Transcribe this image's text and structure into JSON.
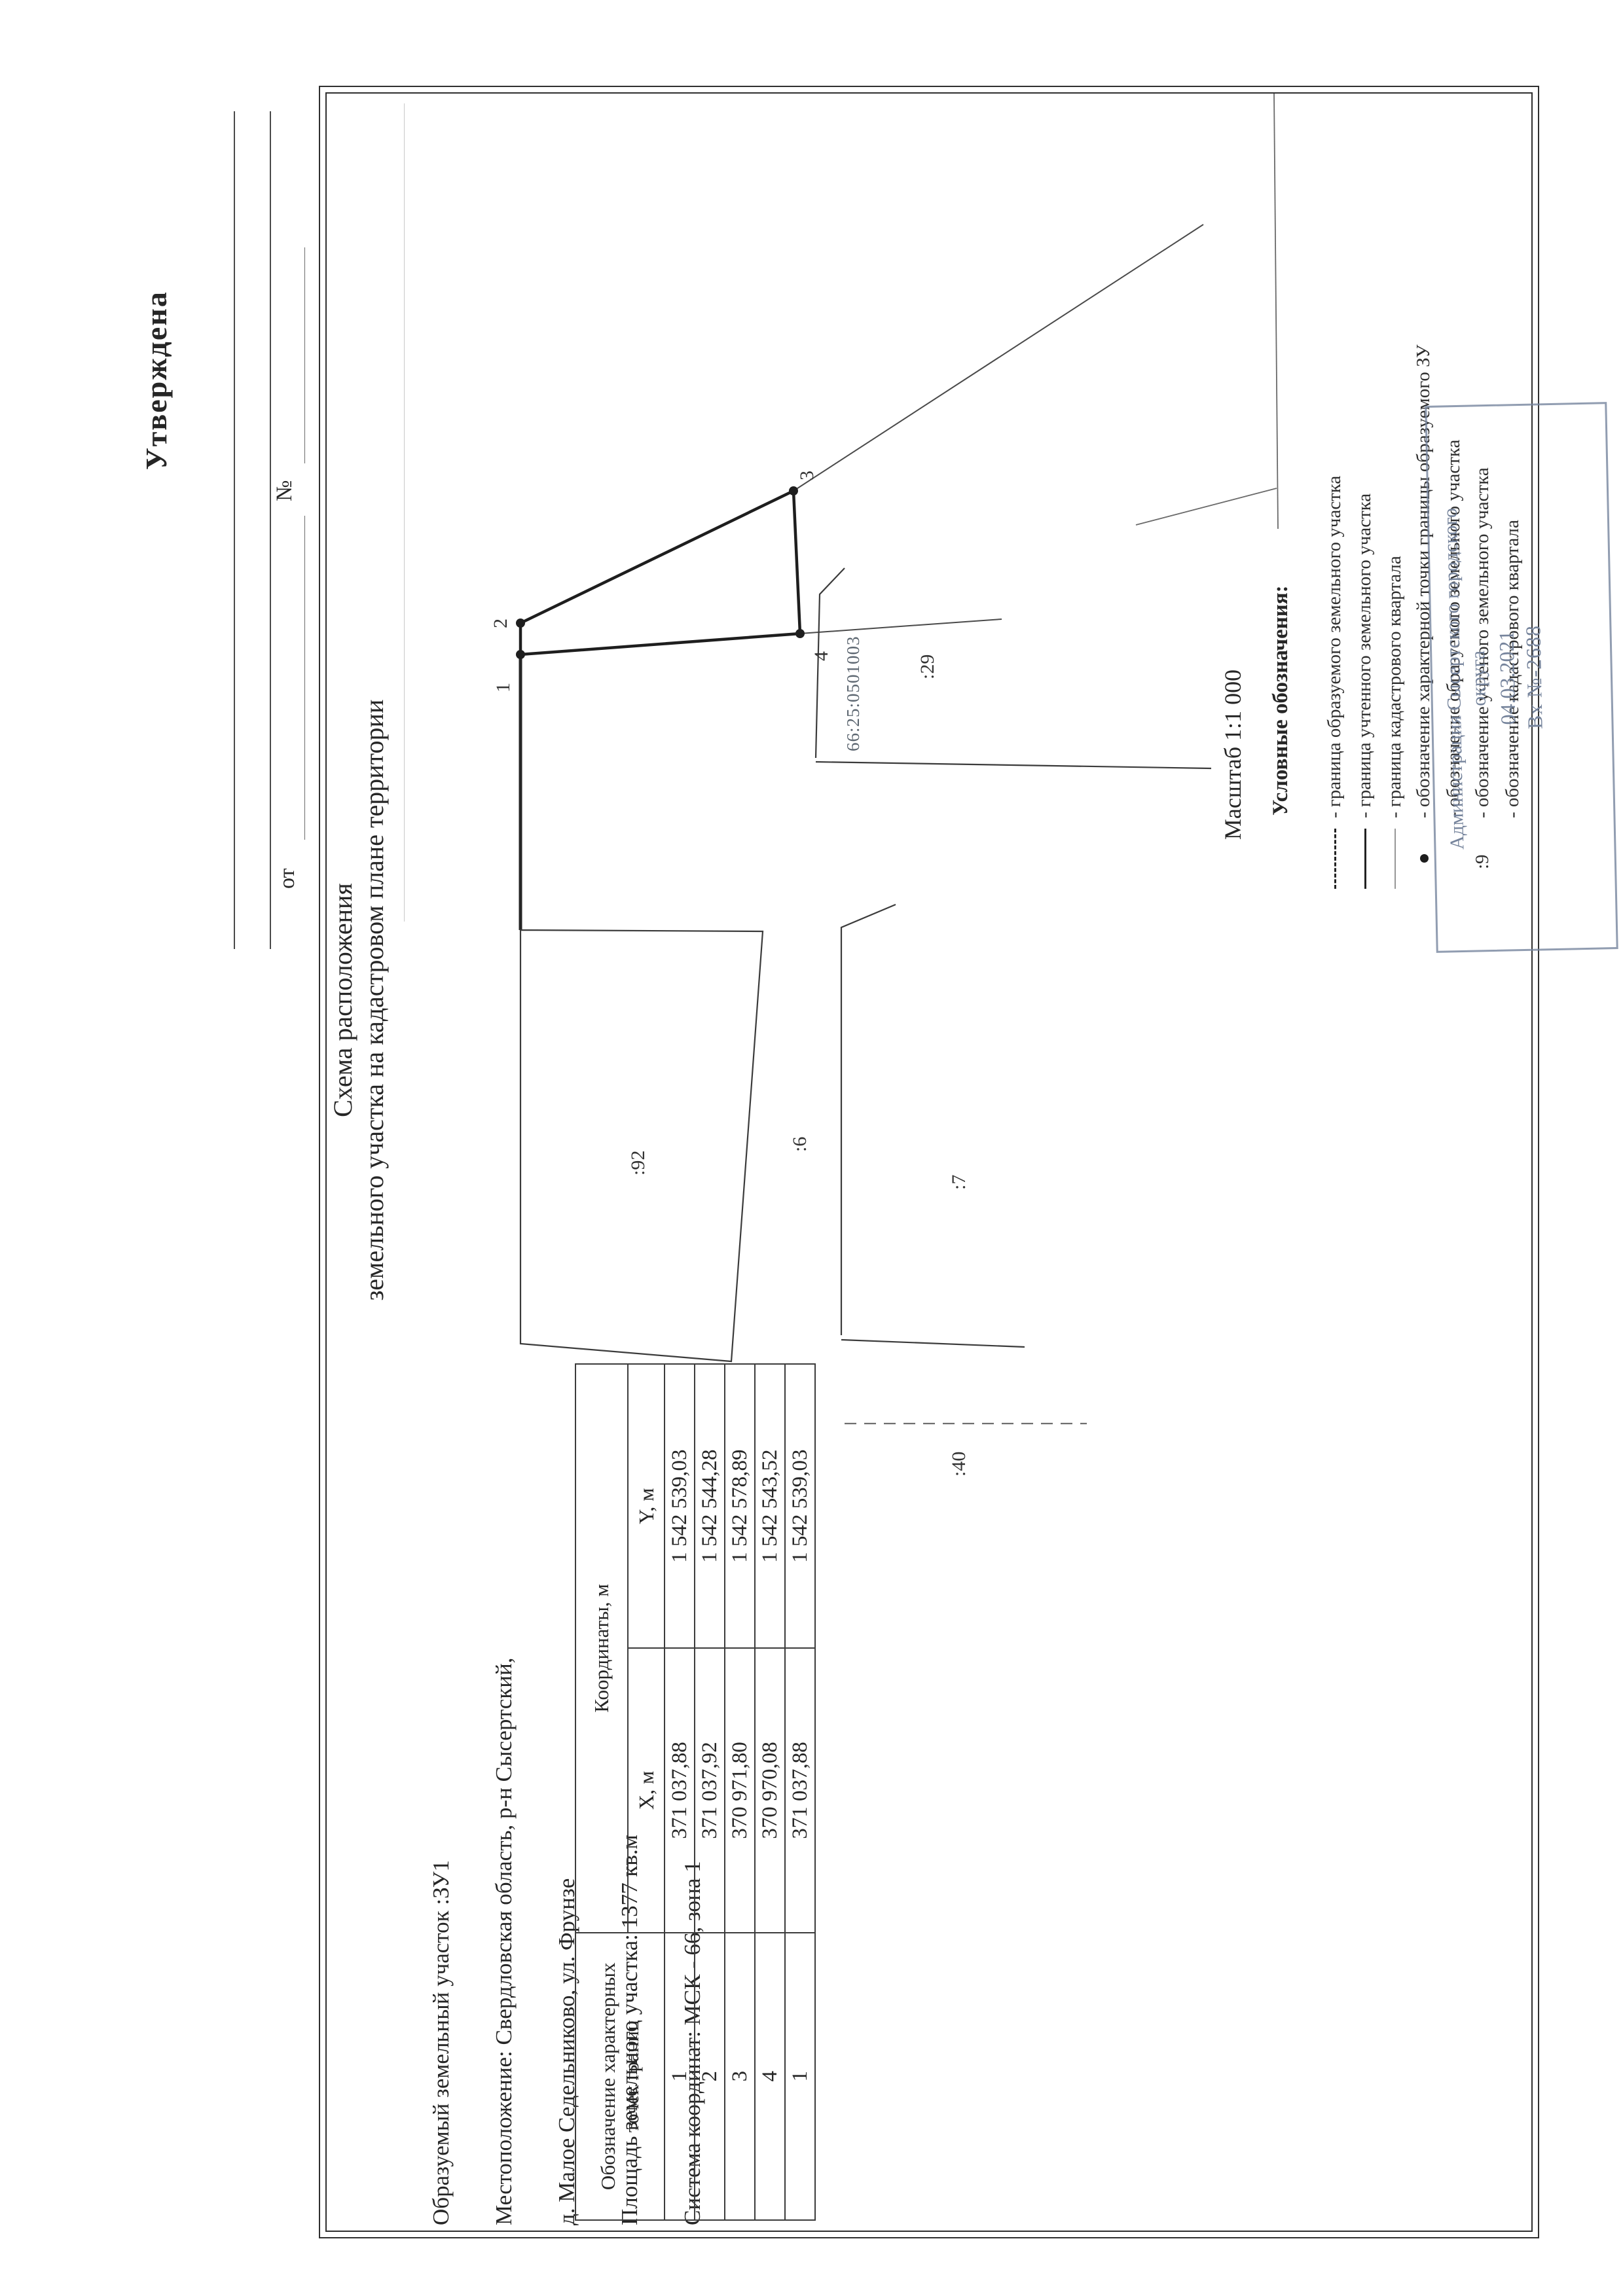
{
  "approval": {
    "title": "Утверждена",
    "ot_label": "от",
    "num_label": "№"
  },
  "doc": {
    "title_line1": "Схема расположения",
    "title_line2": "земельного участка на кадастровом плане территории"
  },
  "info": {
    "lines": [
      "Образуемый земельный участок :ЗУ1",
      "Местоположение: Свердловская область, р-н Сысертский,",
      "д. Малое Седельниково, ул. Фрунзе",
      "Площадь земельного участка: 1377 кв.м",
      "Система координат: МСК - 66, зона 1"
    ]
  },
  "table": {
    "header_col1_line1": "Обозначение характерных",
    "header_col1_line2": "точек границ",
    "header_coords": "Координаты, м",
    "header_x": "X, м",
    "header_y": "Y, м",
    "rows": [
      {
        "n": "1",
        "x": "371 037,88",
        "y": "1 542 539,03"
      },
      {
        "n": "2",
        "x": "371 037,92",
        "y": "1 542 544,28"
      },
      {
        "n": "3",
        "x": "370 971,80",
        "y": "1 542 578,89"
      },
      {
        "n": "4",
        "x": "370 970,08",
        "y": "1 542 543,52"
      },
      {
        "n": "1",
        "x": "371 037,88",
        "y": "1 542 539,03"
      }
    ]
  },
  "map": {
    "scale_label": "Масштаб 1:1 000",
    "quarter_label": "66:25:0501003",
    "points": {
      "p1": "1",
      "p2": "2",
      "p3": "3",
      "p4": "4"
    },
    "parcels": {
      "p92": ":92",
      "p29": ":29",
      "p6": ":6",
      "p7": ":7",
      "p40": ":40"
    }
  },
  "legend": {
    "title": "Условные обозначения:",
    "items": [
      {
        "text": "- граница образуемого земельного участка"
      },
      {
        "text": "- граница учтенного земельного участка"
      },
      {
        "text": "- граница кадастрового квартала"
      },
      {
        "text": "- обозначение характерной точки границы образуемого ЗУ"
      },
      {
        "text": "- обозначение образуемого земельного участка"
      },
      {
        "prefix": ":9",
        "text": "- обозначение учтеного земельного участка"
      },
      {
        "text": "- обозначение кадастрового квартала"
      }
    ]
  },
  "stamp": {
    "line1": "Администрация Сысертского городского",
    "line2": "округа",
    "date": "04.03.2021",
    "number": "Вх №-2688"
  }
}
